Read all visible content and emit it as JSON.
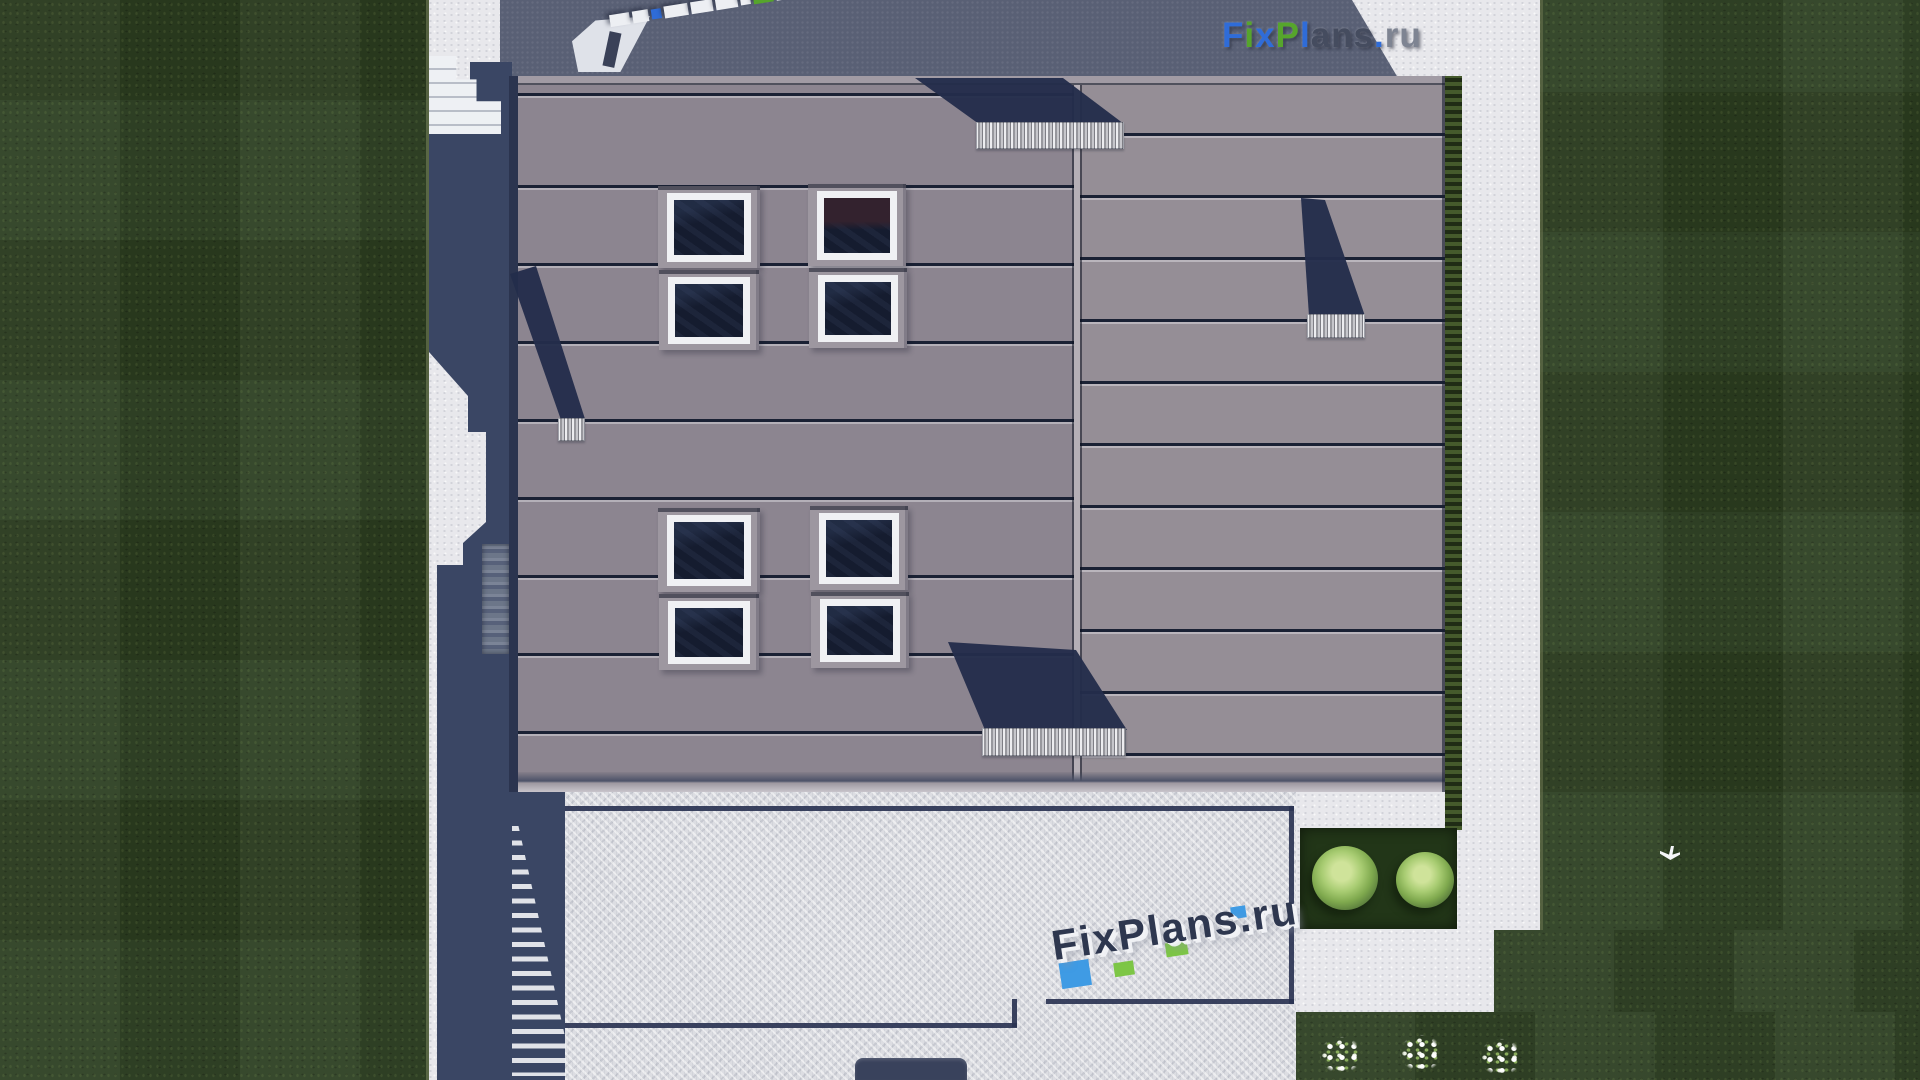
{
  "branding": {
    "logo_topright": {
      "text": "FixPlans.ru",
      "letters": [
        {
          "ch": "F",
          "tone": "blue"
        },
        {
          "ch": "i",
          "tone": "green"
        },
        {
          "ch": "x",
          "tone": "blue"
        },
        {
          "ch": "P",
          "tone": "green"
        },
        {
          "ch": "l",
          "tone": "blue"
        },
        {
          "ch": "a",
          "tone": "dark"
        },
        {
          "ch": "n",
          "tone": "dark"
        },
        {
          "ch": "s",
          "tone": "dark"
        },
        {
          "ch": ".",
          "tone": "blue"
        },
        {
          "ch": "r",
          "tone": "gray"
        },
        {
          "ch": "u",
          "tone": "gray"
        }
      ]
    },
    "watermark_bottom": {
      "text": "FixPlans.ru"
    },
    "watermark_top_blocks": [
      "white",
      "white",
      "blue",
      "white",
      "white",
      "white",
      "white",
      "green",
      "white",
      "green",
      "blue"
    ]
  },
  "scene": {
    "description": "Top-down aerial 3D render of a house roof plan with lawns, walkways, terrace, stairs, bushes and flowers",
    "counts": {
      "skylights": 8,
      "chimneys": 4,
      "bushes": 2,
      "flower_clusters": 3
    }
  },
  "palette": {
    "grass": "#2c3e21",
    "bed": "#223618",
    "pavement": "#e8e8ec",
    "terrace": "#dcdde2",
    "road": "#596075",
    "roof-left": "#8c8590",
    "roof-right": "#958e96",
    "roof-edge": "#2b344f",
    "seam": "#1a2134",
    "shadow": "#3a4664",
    "cshadow": "#232d4b",
    "glass": "#151c2f",
    "glass-red": "#33222e",
    "frame": "#f0f1f4",
    "chimney-a": "#ededf0",
    "chimney-b": "#97979d",
    "border-navy": "#2a3352",
    "logo-blue": "#2f6cd8",
    "logo-green": "#56a52c",
    "logo-dark": "#454c5f",
    "logo-gray": "#7e8492",
    "wm-navy": "#2e374f",
    "wm-blue": "#3f9be4",
    "wm-green": "#7dc646"
  }
}
